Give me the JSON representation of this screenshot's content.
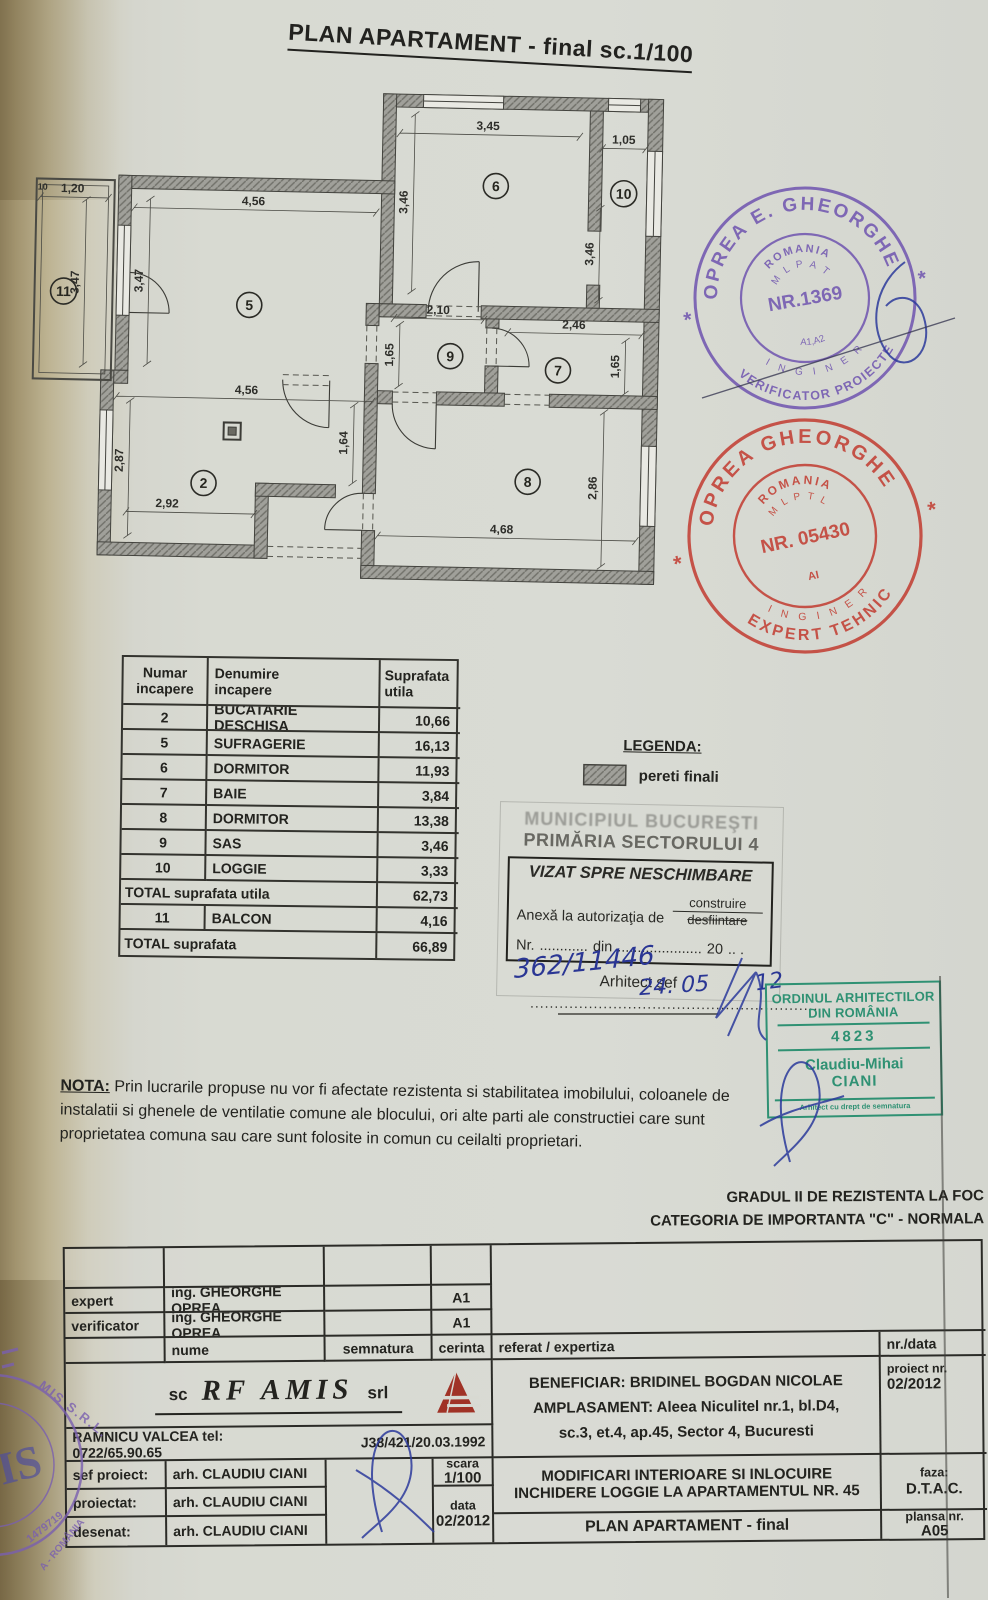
{
  "title": "PLAN APARTAMENT - final  sc.1/100",
  "plan": {
    "rooms": {
      "n2": "2",
      "n5": "5",
      "n6": "6",
      "n7": "7",
      "n8": "8",
      "n9": "9",
      "n10": "10",
      "n11": "11"
    },
    "dims": {
      "d345": "3,45",
      "d105": "1,05",
      "d346a": "3,46",
      "d346b": "3,46",
      "d120": "1,20",
      "d10": "10",
      "d456a": "4,56",
      "d347a": "3,47",
      "d347b": "3,47",
      "d210": "2,10",
      "d246": "2,46",
      "d165a": "1,65",
      "d165b": "1,65",
      "d456b": "4,56",
      "d164": "1,64",
      "d287": "2,87",
      "d292": "2,92",
      "d468": "4,68",
      "d286": "2,86"
    }
  },
  "legend": {
    "title": "LEGENDA:",
    "wall_label": "pereti finali"
  },
  "stamps": {
    "verificator": {
      "outer_top": "OPREA E. GHEORGHE",
      "outer_bottom": "VERIFICATOR PROIECTE",
      "country": "ROMANIA",
      "ministry": "M L P A T",
      "number": "NR.1369",
      "grades": "A1,A2",
      "profession": "I N G I N E R",
      "star": "*"
    },
    "expert": {
      "outer_top": "OPREA GHEORGHE",
      "outer_bottom": "EXPERT TEHNIC",
      "country": "ROMANIA",
      "ministry": "M L P T L",
      "number": "NR. 05430",
      "grades": "AI",
      "profession": "I N G I N E R",
      "star": "*"
    },
    "oar": {
      "line1": "ORDINUL ARHITECTILOR",
      "line2": "DIN ROMÂNIA",
      "number": "4823",
      "name_first": "Claudiu-Mihai",
      "name_last": "CIANI",
      "footer": "Arhitect cu drept de semnatura"
    },
    "amis_seal": {
      "arc_top": "MIS S.R.L.",
      "number": "1479719",
      "arc_bottom": "A - ROMÂNIA",
      "monogram": "IS"
    }
  },
  "visa": {
    "authority1": "MUNICIPIUL BUCUREŞTI",
    "authority2": "PRIMĂRIA SECTORULUI 4",
    "box_title": "VIZAT SPRE NESCHIMBARE",
    "annex_label": "Anexă la autorizaţia de",
    "option_build": "construire",
    "option_demolish": "desfiintare",
    "nr_label": "Nr.",
    "dots1": "............",
    "din_label": "din",
    "dots2": ".....................",
    "year_prefix": "20",
    "dots3": ".. .",
    "hw_number": "362/11446",
    "hw_date": "24. 05",
    "hw_year": "12",
    "signer": "Arhitect şef",
    "dotted_line": "..........................................................."
  },
  "room_table": {
    "headers": [
      {
        "l1": "Numar",
        "l2": "incapere"
      },
      {
        "l1": "Denumire",
        "l2": "incapere"
      },
      {
        "l1": "Suprafata",
        "l2": "utila"
      }
    ],
    "rows": [
      {
        "num": "2",
        "name": "BUCATARIE DESCHISA",
        "area": "10,66"
      },
      {
        "num": "5",
        "name": "SUFRAGERIE",
        "area": "16,13"
      },
      {
        "num": "6",
        "name": "DORMITOR",
        "area": "11,93"
      },
      {
        "num": "7",
        "name": "BAIE",
        "area": "3,84"
      },
      {
        "num": "8",
        "name": "DORMITOR",
        "area": "13,38"
      },
      {
        "num": "9",
        "name": "SAS",
        "area": "3,46"
      },
      {
        "num": "10",
        "name": "LOGGIE",
        "area": "3,33"
      }
    ],
    "total_utila_label": "TOTAL suprafata utila",
    "total_utila_value": "62,73",
    "balcon_row": {
      "num": "11",
      "name": "BALCON",
      "area": "4,16"
    },
    "total_label": "TOTAL suprafata",
    "total_value": "66,89"
  },
  "nota": {
    "label": "NOTA:",
    "text": " Prin lucrarile propuse nu vor fi afectate rezistenta si stabilitatea imobilului, coloanele de instalatii si ghenele de ventilatie comune ale blocului, ori alte parti ale constructiei care sunt proprietatea comuna sau care sunt folosite in comun cu ceilalti proprietari."
  },
  "fire_rating": {
    "line1": "GRADUL II DE REZISTENTA LA FOC",
    "line2": "CATEGORIA DE IMPORTANTA \"C\" -  NORMALA"
  },
  "titleblock": {
    "expert_label": "expert",
    "expert_name": "ing. GHEORGHE OPREA",
    "expert_cerinta": "A1",
    "verificator_label": "verificator",
    "verificator_name": "ing. GHEORGHE OPREA",
    "verificator_cerinta": "A1",
    "nume_label": "nume",
    "semnatura_label": "semnatura",
    "cerinta_label": "cerinta",
    "referat_label": "referat / expertiza",
    "nr_data_label": "nr./data",
    "company_prefix": "sc",
    "company_name": "RF AMIS",
    "company_suffix": "srl",
    "company_line": "RAMNICU VALCEA  tel: 0722/65.90.65",
    "company_reg": "J38/421/20.03.1992",
    "beneficiar": "BENEFICIAR: BRIDINEL BOGDAN NICOLAE",
    "amplasament1": "AMPLASAMENT: Aleea Niculitel nr.1, bl.D4,",
    "amplasament2": "sc.3, et.4, ap.45, Sector 4, Bucuresti",
    "proiect_label": "proiect nr.",
    "proiect_value": "02/2012",
    "sef_label": "sef proiect:",
    "sef_name": "arh. CLAUDIU CIANI",
    "proiectat_label": "proiectat:",
    "proiectat_name": "arh. CLAUDIU CIANI",
    "desenat_label": "desenat:",
    "desenat_name": "arh. CLAUDIU CIANI",
    "scara_label": "scara",
    "scara_value": "1/100",
    "data_label": "data",
    "data_value": "02/2012",
    "lucrare1": "MODIFICARI INTERIOARE SI INLOCUIRE",
    "lucrare2": "INCHIDERE LOGGIE LA APARTAMENTUL NR. 45",
    "faza_label": "faza:",
    "faza_value": "D.T.A.C.",
    "plansa_title": "PLAN APARTAMENT - final",
    "plansa_label": "plansa nr.",
    "plansa_value": "A05"
  },
  "colors": {
    "stamp_purple": "#6b4fae",
    "stamp_red": "#c23b30",
    "stamp_green": "#2f9173",
    "signature_blue": "#2b3a9b",
    "logo_red": "#a03226",
    "wall_gray": "#a0a09a"
  }
}
